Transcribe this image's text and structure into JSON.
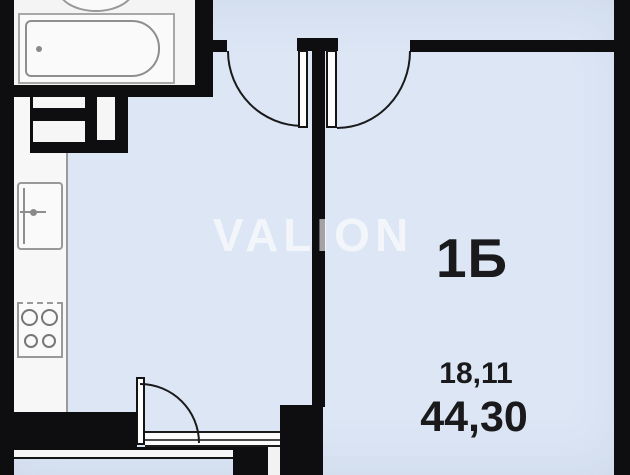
{
  "watermark": {
    "text": "VALION"
  },
  "labels": {
    "unit": "1Б",
    "room_area": "18,11",
    "total_area": "44,30"
  },
  "colors": {
    "background": "#dce6f5",
    "wall": "#0e0e10",
    "bathroom_floor": "#f4f4f4",
    "fixture_outline": "#999999",
    "label_text": "#1a1a1c",
    "watermark_text": "rgba(255,255,255,0.62)"
  },
  "fixtures": {
    "bathtub": "bathtub-icon",
    "washbasin": "washbasin-icon",
    "kitchen_sink": "kitchen-sink-icon",
    "stove": "stove-icon",
    "ventilation_shaft": "vent-shaft-icon",
    "entry_door": "door-arc-icon",
    "room_door": "door-arc-icon",
    "balcony_door": "door-arc-icon",
    "window": "window-icon",
    "balcony": "balcony-parapet"
  }
}
